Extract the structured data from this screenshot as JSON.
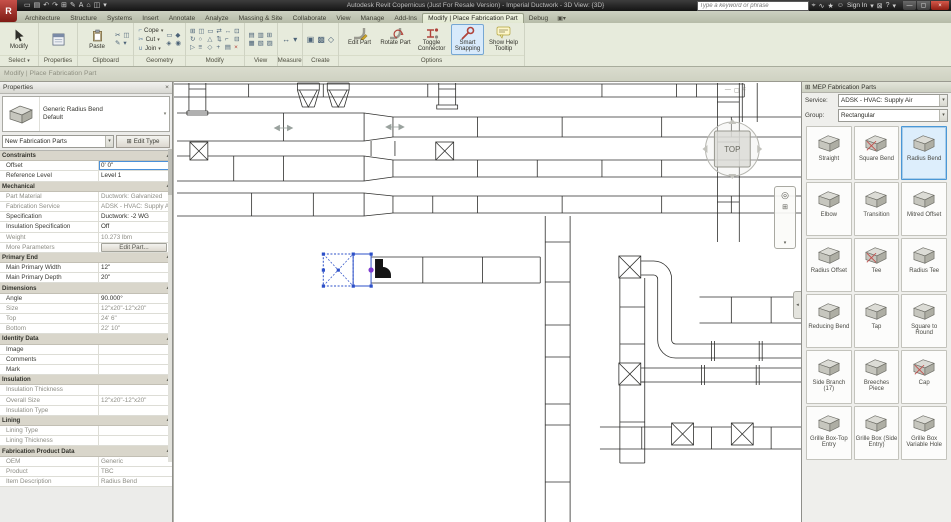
{
  "title_bar": {
    "app_button": "R",
    "qat_icons": [
      {
        "name": "open-icon",
        "glyph": "▭"
      },
      {
        "name": "save-icon",
        "glyph": "▤"
      },
      {
        "name": "undo-icon",
        "glyph": "↶"
      },
      {
        "name": "redo-icon",
        "glyph": "↷"
      },
      {
        "name": "print-icon",
        "glyph": "⊞"
      },
      {
        "name": "annotate-icon",
        "glyph": "✎"
      },
      {
        "name": "text-icon",
        "glyph": "A"
      },
      {
        "name": "default-3d-view-icon",
        "glyph": "⌂"
      },
      {
        "name": "switch-windows-icon",
        "glyph": "◫"
      },
      {
        "name": "customize-qat-icon",
        "glyph": "▾"
      }
    ],
    "app_title": "Autodesk Revit Copernicus (Just For Resale Version) - Imperial Ductwork - 3D View: {3D}",
    "search_placeholder": "Type a keyword or phrase",
    "infocenter_icons": [
      {
        "name": "search-button-icon",
        "glyph": "⌖"
      },
      {
        "name": "subscription-center-icon",
        "glyph": "∿"
      },
      {
        "name": "favorites-icon",
        "glyph": "★"
      },
      {
        "name": "user-icon",
        "glyph": "☺"
      }
    ],
    "sign_in_label": "Sign In",
    "signin_caret": "▾",
    "exchange_icon": "⊠",
    "help_icon": "?",
    "help_caret": "▾",
    "window_buttons": [
      {
        "name": "minimize-button",
        "glyph": "—"
      },
      {
        "name": "maximize-button",
        "glyph": "▢"
      },
      {
        "name": "close-button",
        "glyph": "×",
        "red": true
      }
    ]
  },
  "tabs": [
    {
      "label": "Architecture"
    },
    {
      "label": "Structure"
    },
    {
      "label": "Systems"
    },
    {
      "label": "Insert"
    },
    {
      "label": "Annotate"
    },
    {
      "label": "Analyze"
    },
    {
      "label": "Massing & Site"
    },
    {
      "label": "Collaborate"
    },
    {
      "label": "View"
    },
    {
      "label": "Manage"
    },
    {
      "label": "Add-Ins"
    },
    {
      "label": "Modify | Place Fabrication Part",
      "active": true
    },
    {
      "label": "Debug"
    }
  ],
  "ribbon": {
    "select": {
      "modify_label": "Modify",
      "panel_label": "Select",
      "caret": "▾"
    },
    "properties": {
      "panel_label": "Properties"
    },
    "clipboard": {
      "paste_label": "Paste",
      "panel_label": "Clipboard",
      "small_icons": [
        {
          "name": "cut-icon",
          "glyph": "✂"
        },
        {
          "name": "copy-icon",
          "glyph": "◫"
        },
        {
          "name": "match-type-icon",
          "glyph": "✎"
        },
        {
          "name": "paste-caret-icon",
          "glyph": "▾"
        }
      ]
    },
    "geometry": {
      "panel_label": "Geometry",
      "items": [
        {
          "icon_name": "cope-icon",
          "glyph": "⌐",
          "label": "Cope",
          "caret": "▾"
        },
        {
          "icon_name": "cut-geometry-icon",
          "glyph": "✂",
          "label": "Cut",
          "caret": "▾"
        },
        {
          "icon_name": "join-icon",
          "glyph": "∪",
          "label": "Join",
          "caret": "▾"
        }
      ],
      "extra_icons": [
        {
          "name": "beam-joins-icon",
          "glyph": "▭"
        },
        {
          "name": "wall-joins-icon",
          "glyph": "◆"
        },
        {
          "name": "demolish-icon",
          "glyph": "◈"
        },
        {
          "name": "paint-icon",
          "glyph": "◉"
        }
      ]
    },
    "modify": {
      "panel_label": "Modify",
      "icons": [
        {
          "name": "align-icon",
          "glyph": "⊞"
        },
        {
          "name": "copy-icon",
          "glyph": "◫"
        },
        {
          "name": "offset-icon",
          "glyph": "▭"
        },
        {
          "name": "move-icon",
          "glyph": "⇄"
        },
        {
          "name": "mirror-icon",
          "glyph": "↔"
        },
        {
          "name": "pin-icon",
          "glyph": "⊡"
        },
        {
          "name": "rotate-icon",
          "glyph": "↻"
        },
        {
          "name": "array-icon",
          "glyph": "○"
        },
        {
          "name": "scale-icon",
          "glyph": "△"
        },
        {
          "name": "split-icon",
          "glyph": "⇅"
        },
        {
          "name": "trim-icon",
          "glyph": "⌐"
        },
        {
          "name": "unpin-icon",
          "glyph": "⊟"
        },
        {
          "name": "extend-icon",
          "glyph": "▷"
        },
        {
          "name": "match-icon",
          "glyph": "≡"
        },
        {
          "name": "join-geometry-icon",
          "glyph": "◇"
        },
        {
          "name": "add-icon",
          "glyph": "+"
        },
        {
          "name": "wall-icon",
          "glyph": "▤"
        },
        {
          "name": "delete-icon",
          "glyph": "×",
          "red": true
        }
      ]
    },
    "view": {
      "panel_label": "View",
      "icons": [
        {
          "name": "thin-lines-icon",
          "glyph": "▤"
        },
        {
          "name": "hidden-windows-icon",
          "glyph": "▥"
        },
        {
          "name": "tile-windows-icon",
          "glyph": "⊞"
        },
        {
          "name": "cascade-icon",
          "glyph": "▦"
        },
        {
          "name": "user-interface-icon",
          "glyph": "▧"
        },
        {
          "name": "switch-window-icon",
          "glyph": "▨"
        }
      ]
    },
    "measure": {
      "panel_label": "Measure",
      "icons": [
        {
          "name": "measure-icon",
          "glyph": "↔"
        },
        {
          "name": "measure-caret-icon",
          "glyph": "▾"
        }
      ]
    },
    "create": {
      "panel_label": "Create",
      "icons": [
        {
          "name": "create-similar-icon",
          "glyph": "▣"
        },
        {
          "name": "create-group-icon",
          "glyph": "▩"
        },
        {
          "name": "create-assembly-icon",
          "glyph": "◇"
        }
      ]
    },
    "options": {
      "panel_label": "Options",
      "buttons": [
        {
          "label": "Edit Part",
          "icon": "edit-part-icon"
        },
        {
          "label": "Rotate Part",
          "icon": "rotate-part-icon"
        },
        {
          "label": "Toggle Connector",
          "icon": "toggle-connector-icon"
        },
        {
          "label": "Smart Snapping",
          "icon": "smart-snapping-icon",
          "active": true
        },
        {
          "label": "Show Help Tooltip",
          "icon": "show-help-tooltip-icon"
        }
      ]
    }
  },
  "mode_bar": {
    "text": "Modify | Place Fabrication Part"
  },
  "properties_panel": {
    "title": "Properties",
    "close_icon": "×",
    "type_name": "Generic Radius Bend",
    "type_sub": "Default",
    "preview_caret": "▾",
    "selector_value": "New Fabrication Parts",
    "selector_caret": "▾",
    "edit_type_label": "Edit Type",
    "edit_type_icon": "⊞",
    "rows": [
      {
        "t": "header",
        "label": "Constraints"
      },
      {
        "t": "row",
        "label": "Offset",
        "value": "0' 0\"",
        "selected": true
      },
      {
        "t": "row",
        "label": "Reference Level",
        "value": "Level 1"
      },
      {
        "t": "header",
        "label": "Mechanical"
      },
      {
        "t": "row",
        "label": "Part Material",
        "value": "Ductwork: Galvanized",
        "dim": true
      },
      {
        "t": "row",
        "label": "Fabrication Service",
        "value": "ADSK - HVAC: Supply Air",
        "dim": true
      },
      {
        "t": "row",
        "label": "Specification",
        "value": "Ductwork: -2 WG"
      },
      {
        "t": "row",
        "label": "Insulation Specification",
        "value": "Off"
      },
      {
        "t": "row",
        "label": "Weight",
        "value": "10.273 lbm",
        "dim": true
      },
      {
        "t": "row",
        "label": "More Parameters",
        "value": "Edit Part...",
        "button": true,
        "dim": true
      },
      {
        "t": "header",
        "label": "Primary End"
      },
      {
        "t": "row",
        "label": "Main Primary Width",
        "value": "12\""
      },
      {
        "t": "row",
        "label": "Main Primary Depth",
        "value": "20\""
      },
      {
        "t": "header",
        "label": "Dimensions"
      },
      {
        "t": "row",
        "label": "Angle",
        "value": "90.000°"
      },
      {
        "t": "row",
        "label": "Size",
        "value": "12\"x20\"-12\"x20\"",
        "dim": true
      },
      {
        "t": "row",
        "label": "Top",
        "value": "24' 6\"",
        "dim": true
      },
      {
        "t": "row",
        "label": "Bottom",
        "value": "22' 10\"",
        "dim": true
      },
      {
        "t": "header",
        "label": "Identity Data"
      },
      {
        "t": "row",
        "label": "Image",
        "value": ""
      },
      {
        "t": "row",
        "label": "Comments",
        "value": ""
      },
      {
        "t": "row",
        "label": "Mark",
        "value": ""
      },
      {
        "t": "header",
        "label": "Insulation"
      },
      {
        "t": "row",
        "label": "Insulation Thickness",
        "value": "",
        "dim": true
      },
      {
        "t": "row",
        "label": "Overall Size",
        "value": "12\"x20\"-12\"x20\"",
        "dim": true
      },
      {
        "t": "row",
        "label": "Insulation Type",
        "value": "",
        "dim": true
      },
      {
        "t": "header",
        "label": "Lining"
      },
      {
        "t": "row",
        "label": "Lining Type",
        "value": "",
        "dim": true
      },
      {
        "t": "row",
        "label": "Lining Thickness",
        "value": "",
        "dim": true
      },
      {
        "t": "header",
        "label": "Fabrication Product Data"
      },
      {
        "t": "row",
        "label": "OEM",
        "value": "Generic",
        "dim": true
      },
      {
        "t": "row",
        "label": "Product",
        "value": "TBC",
        "dim": true
      },
      {
        "t": "row",
        "label": "Item Description",
        "value": "Radius Bend",
        "dim": true
      }
    ]
  },
  "canvas": {
    "viewcube_label": "TOP",
    "view_controls": [
      {
        "name": "view-minimize-icon",
        "glyph": "—"
      },
      {
        "name": "view-restore-icon",
        "glyph": "▢"
      },
      {
        "name": "view-close-icon",
        "glyph": "×"
      }
    ],
    "navbar_icons": [
      {
        "name": "steering-wheel-icon",
        "glyph": "◎",
        "cls": "n1"
      },
      {
        "name": "zoom-icon",
        "glyph": "⊞",
        "cls": "n2"
      },
      {
        "name": "navbar-more-icon",
        "glyph": "▾",
        "cls": "n3"
      }
    ],
    "collapse_tab_icon": "◂"
  },
  "parts_panel": {
    "title": "MEP Fabrication Parts",
    "header_icon": "⊞",
    "service_label": "Service:",
    "service_value": "ADSK - HVAC: Supply Air",
    "group_label": "Group:",
    "group_value": "Rectangular",
    "caret": "▾",
    "items": [
      {
        "label": "Straight",
        "icon": "straight-part-icon"
      },
      {
        "label": "Square Bend",
        "icon": "square-bend-part-icon",
        "red": true
      },
      {
        "label": "Radius Bend",
        "icon": "radius-bend-part-icon",
        "selected": true
      },
      {
        "label": "Elbow",
        "icon": "elbow-part-icon"
      },
      {
        "label": "Transition",
        "icon": "transition-part-icon"
      },
      {
        "label": "Mitred Offset",
        "icon": "mitred-offset-part-icon"
      },
      {
        "label": "Radius Offset",
        "icon": "radius-offset-part-icon"
      },
      {
        "label": "Tee",
        "icon": "tee-part-icon",
        "red": true
      },
      {
        "label": "Radius Tee",
        "icon": "radius-tee-part-icon"
      },
      {
        "label": "Reducing Bend",
        "icon": "reducing-bend-part-icon"
      },
      {
        "label": "Tap",
        "icon": "tap-part-icon"
      },
      {
        "label": "Square to Round",
        "icon": "square-to-round-part-icon"
      },
      {
        "label": "Side Branch (17)",
        "icon": "side-branch-part-icon"
      },
      {
        "label": "Breeches Piece",
        "icon": "breeches-piece-part-icon"
      },
      {
        "label": "Cap",
        "icon": "cap-part-icon",
        "red": true
      },
      {
        "label": "Grille Box-Top Entry",
        "icon": "grille-box-top-entry-part-icon"
      },
      {
        "label": "Grille Box (Side Entry)",
        "icon": "grille-box-side-entry-part-icon"
      },
      {
        "label": "Grille Box Variable Hole",
        "icon": "grille-box-variable-hole-part-icon"
      }
    ]
  },
  "colors": {
    "selection_blue": "#2d50c8",
    "connector_purple": "#7d3bd0",
    "smart_snapping_highlight": "#d8eafb",
    "accent_border": "#76a7d3",
    "close_red": "#9e2518",
    "contextual_tab": "#e9eed9"
  }
}
